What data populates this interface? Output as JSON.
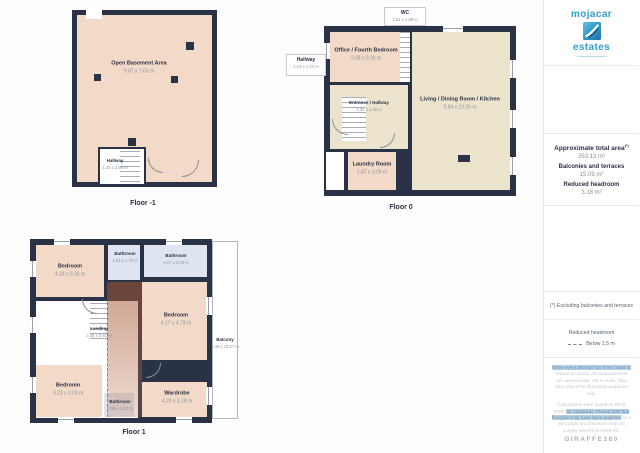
{
  "floors": [
    {
      "label": "Floor -1",
      "rooms": [
        {
          "name": "Open Basement Area",
          "dims": "9.87 x 7.03 m"
        },
        {
          "name": "Hallway",
          "dims": "1.20 x 2.98 m"
        }
      ]
    },
    {
      "label": "Floor 0",
      "rooms": [
        {
          "name": "WC",
          "dims": "1.52 x 1.89 m"
        },
        {
          "name": "Office / Fourth Bedroom",
          "dims": "3.08 x 3.26 m"
        },
        {
          "name": "Hallway",
          "dims": "1.13 x 1.22 m"
        },
        {
          "name": "Entrance / Hallway",
          "dims": "2.30 x 4.48 m"
        },
        {
          "name": "Living / Dining Room / Kitchen",
          "dims": "5.94 x 10.26 m"
        },
        {
          "name": "Laundry Room",
          "dims": "2.87 x 3.28 m"
        }
      ]
    },
    {
      "label": "Floor 1",
      "rooms": [
        {
          "name": "Bedroom",
          "dims": "4.28 x 3.36 m"
        },
        {
          "name": "Bathroom",
          "dims": "1.92 x 1.75 m"
        },
        {
          "name": "Bathroom",
          "dims": "4.17 x 2.06 m"
        },
        {
          "name": "Landing",
          "dims": "2.05 x 5.51 m"
        },
        {
          "name": "Bedroom",
          "dims": "4.17 x 4.73 m"
        },
        {
          "name": "Bedroom",
          "dims": "3.23 x 3.24 m"
        },
        {
          "name": "Bathroom",
          "dims": "2.06 x 2.02 m"
        },
        {
          "name": "Wardrobe",
          "dims": "4.20 x 3.18 m"
        },
        {
          "name": "Balcony",
          "dims": "1.46 x 10.27 m"
        }
      ]
    }
  ],
  "sidebar": {
    "logo": {
      "top": "mojacar",
      "bottom": "estates"
    },
    "stats": [
      {
        "label": "Approximate total area",
        "sup": "(*)",
        "value": "253.13 m²"
      },
      {
        "label": "Balconies and terraces",
        "value": "15.05 m²"
      },
      {
        "label": "Reduced headroom",
        "value": "3.18 m²"
      }
    ],
    "note": "(*) Excluding balconies and terraces",
    "legend": {
      "title": "Reduced headroom",
      "item": "Below 1.5 m"
    },
    "disclaimer1_hl": "While every attempt has been made to",
    "disclaimer1_rest": " ensure accuracy, all measurements are approximate, not to scale. This floor plan is for illustrative purposes only.",
    "disclaimer2_a": "Calculations were based on RICS IPMS ",
    "disclaimer2_hl": "3C standards. Please note that floorplan may have been adjusted",
    "disclaimer2_rest": " by a third party and therefore may not comply with RICS IPMS 3C.",
    "brand": "GIRAFFE360"
  },
  "colors": {
    "wall": "#2a3245",
    "room_warm": "#f3d9c7",
    "room_tan": "#ece3cd",
    "room_cool": "#dfe5f0",
    "accent_blue": "#2f9fd0"
  }
}
